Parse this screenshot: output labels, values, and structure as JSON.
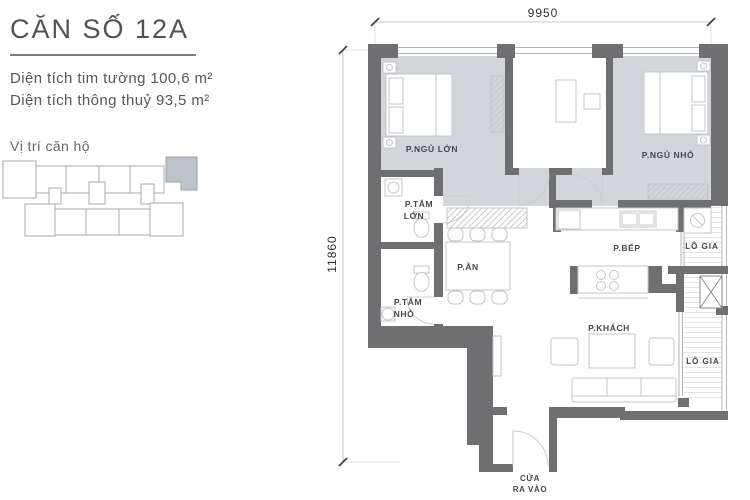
{
  "info_panel": {
    "title": "CĂN SỐ 12A",
    "area_tim_tuong": "Diện tích tim tường 100,6 m²",
    "area_thong_thuy": "Diện tích thông thuỷ 93,5 m²",
    "location_label": "Vị trí căn hộ"
  },
  "floor_plan": {
    "dim_width": "9950",
    "dim_height": "11860",
    "labels": {
      "master_bedroom": "P.NGỦ LỚN",
      "small_bedroom": "P.NGỦ NHỎ",
      "bath_big_1": "P.TẮM",
      "bath_big_2": "LỚN",
      "bath_small_1": "P.TẮM",
      "bath_small_2": "NHỎ",
      "dining": "P.ĂN",
      "kitchen": "P.BẾP",
      "living": "P.KHÁCH",
      "loggia_top": "LÔ GIA",
      "loggia_bottom": "LÔ GIA",
      "entrance_1": "CỬA",
      "entrance_2": "RA VÀO"
    },
    "colors": {
      "wall": "#6f6f71",
      "bedroom_floor": "#d2d6db",
      "minimap_highlight": "#bcc3ca"
    }
  }
}
